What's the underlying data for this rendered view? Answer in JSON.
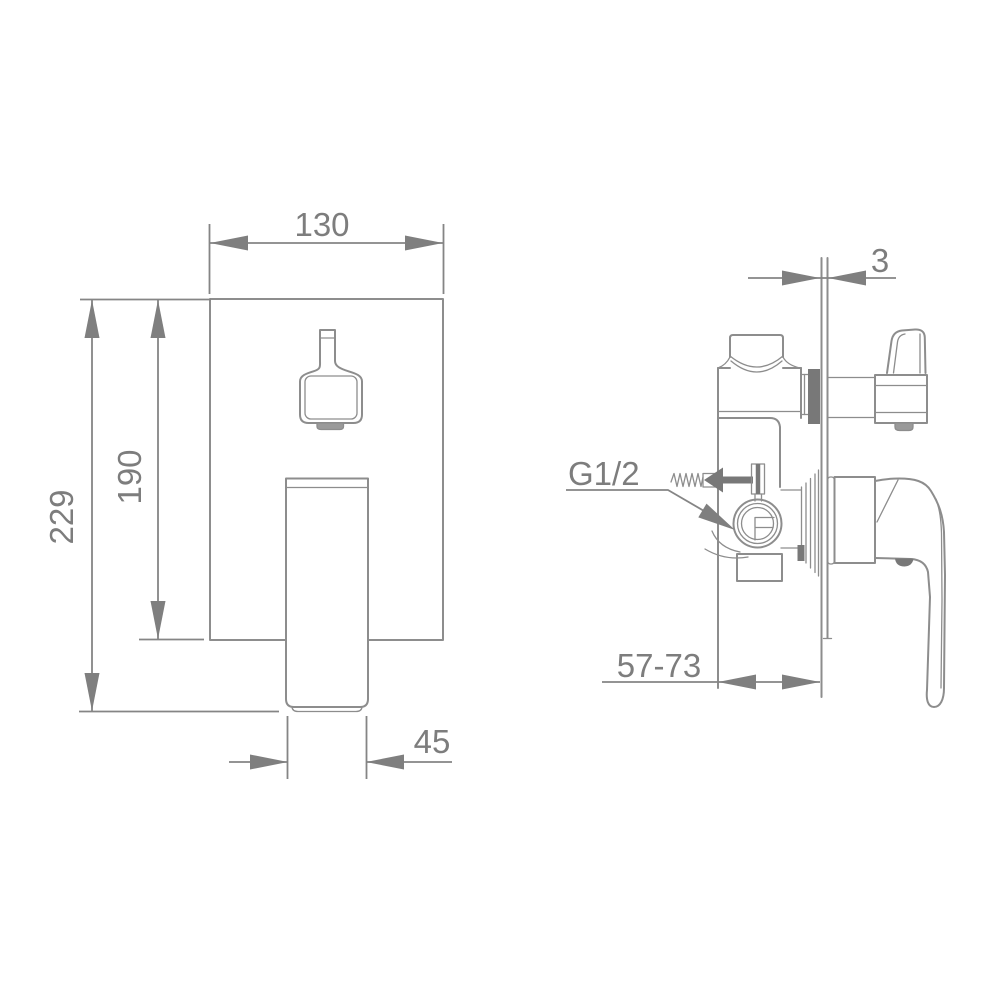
{
  "colors": {
    "background": "#ffffff",
    "line": "#8d8d8d",
    "dark_fill": "#787878",
    "text": "#7d7d7d"
  },
  "drawing": {
    "kind": "installation-dimension-diagram",
    "subject": "concealed-shower-mixer-valve",
    "front_view": {
      "plate_width_label": "130",
      "overall_height_label": "229",
      "plate_height_label": "190",
      "handle_width_label": "45"
    },
    "side_view": {
      "plate_thickness_label": "3",
      "install_depth_label": "57-73",
      "thread_label": "G1/2"
    }
  }
}
